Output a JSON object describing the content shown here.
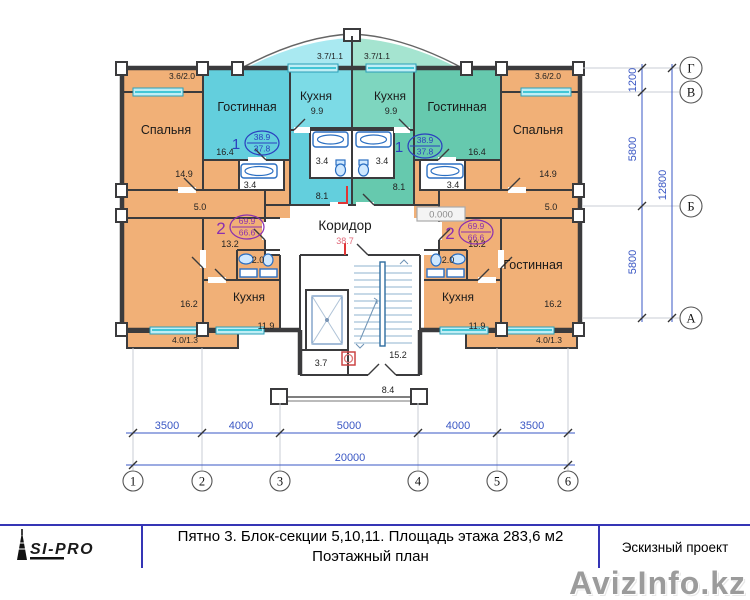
{
  "watermark": "AvizInfo.kz",
  "logo": {
    "name": "SI-PRO"
  },
  "title_block": {
    "line1": "Пятно 3. Блок-секции 5,10,11. Площадь этажа 283,6 м2",
    "line2": "Поэтажный план",
    "project_type": "Эскизный проект"
  },
  "plan": {
    "room_names": {
      "bedroom": "Спальня",
      "kitchen": "Кухня",
      "living": "Гостинная",
      "corridor": "Коридор"
    },
    "areas": {
      "bedroom": "14.9",
      "living_top": "16.4",
      "kitchen_top": "9.9",
      "bath": "3.4",
      "hall_top": "8.1",
      "hall_small": "5.0",
      "hall_mid": "13.2",
      "bath_small": "2.0",
      "kitchen_bottom": "11.9",
      "living_bottom": "16.2",
      "corridor": "38.7",
      "stair": "15.2",
      "chute": "3.7",
      "vestibule": "8.4",
      "balcony_top_center": "3.7/1.1",
      "balcony_top_corner": "3.6/2.0",
      "balcony_bottom": "4.0/1.3"
    },
    "stamps": {
      "apt1": {
        "num": "1",
        "area_total": "38.9",
        "area_living": "37.8"
      },
      "apt2": {
        "num": "2",
        "area_total": "69.9",
        "area_living": "66.6"
      }
    },
    "level_mark": "0.000",
    "grid": {
      "cols": [
        "1",
        "2",
        "3",
        "4",
        "5",
        "6"
      ],
      "rows": [
        "Г",
        "В",
        "Б",
        "А"
      ]
    },
    "dims": {
      "bottom": [
        "3500",
        "4000",
        "5000",
        "4000",
        "3500"
      ],
      "bottom_total": "20000",
      "right": [
        "1200",
        "5800",
        "5800"
      ],
      "right_total": "12800"
    },
    "colors": {
      "apartment_orange": "#f1b077",
      "apartment_cyan": "#63cfdd",
      "apartment_cyan_light": "#7cdbe6",
      "apartment_teal": "#66c9ae",
      "apartment_teal_light": "#7ed6bf",
      "balcony_cyan": "#a9e9f1",
      "balcony_teal": "#a5e4d0",
      "wall": "#3b3b3d",
      "window": "#35c8dc",
      "dimension_blue": "#3a57c4",
      "stamp_blue": "#2b3fbf",
      "stamp_purple": "#8b2fb0",
      "accent_red": "#e03535",
      "title_border": "#3535b5"
    }
  }
}
